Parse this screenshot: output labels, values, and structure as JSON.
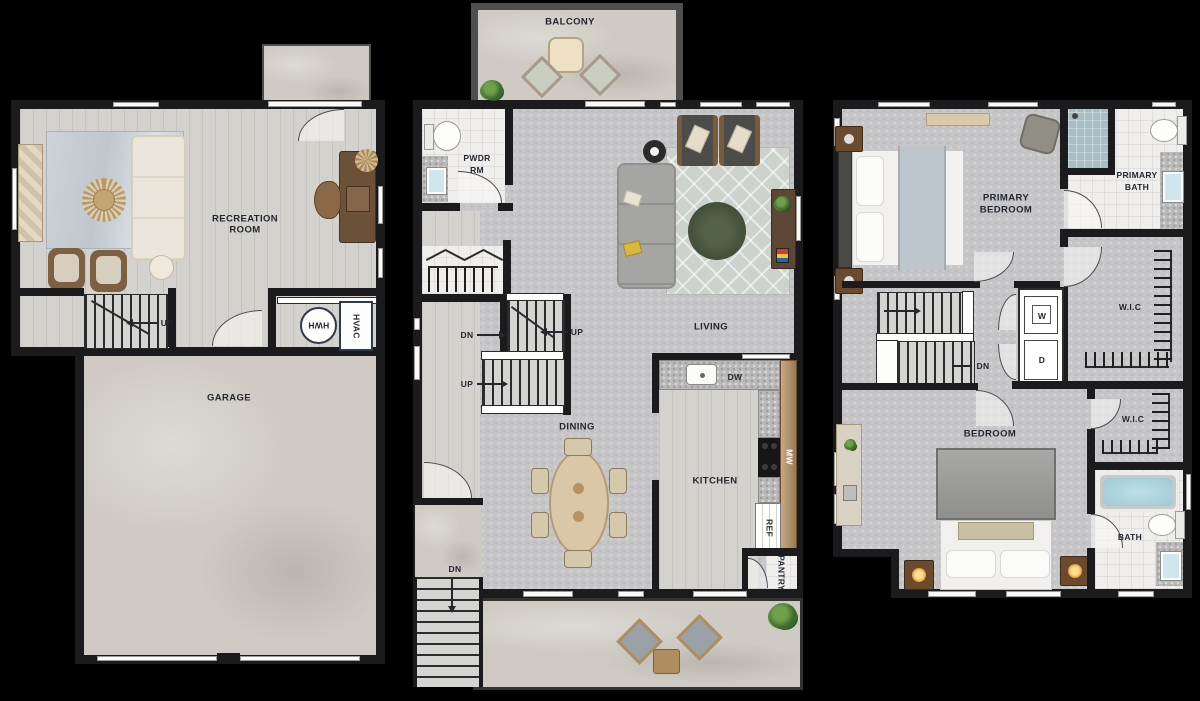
{
  "title": "Three-level townhome floor plan",
  "colors": {
    "background": "#000000",
    "wall": "#1b1b1d",
    "floor_gray": "#c6c6c8",
    "floor_wood": "#d4d2ce",
    "concrete": "#cfcbc4",
    "tile_white": "#efeeec",
    "rug_green": "#47523c",
    "cabinet_tan": "#b5926c",
    "label_text": "#23272f"
  },
  "plans": {
    "first": {
      "labels": {
        "recreation_1": "RECREATION",
        "recreation_2": "ROOM",
        "up": "UP",
        "garage": "GARAGE",
        "hwh": "HWH",
        "hvac": "HVAC"
      }
    },
    "second": {
      "labels": {
        "balcony": "BALCONY",
        "pwdr_1": "PWDR",
        "pwdr_2": "RM",
        "living": "LIVING",
        "dn_upper": "DN",
        "up_upper": "UP",
        "up_lower": "UP",
        "dining": "DINING",
        "kitchen": "KITCHEN",
        "dw": "DW",
        "mw": "MW",
        "ref": "REF",
        "pantry": "PANTRY",
        "dn_exterior": "DN"
      }
    },
    "third": {
      "labels": {
        "primary_bedroom_1": "PRIMARY",
        "primary_bedroom_2": "BEDROOM",
        "primary_bath_1": "PRIMARY",
        "primary_bath_2": "BATH",
        "wic_upper": "W.I.C",
        "washer": "W",
        "dryer": "D",
        "dn": "DN",
        "bedroom": "BEDROOM",
        "wic_lower": "W.I.C",
        "bath": "BATH"
      }
    }
  }
}
